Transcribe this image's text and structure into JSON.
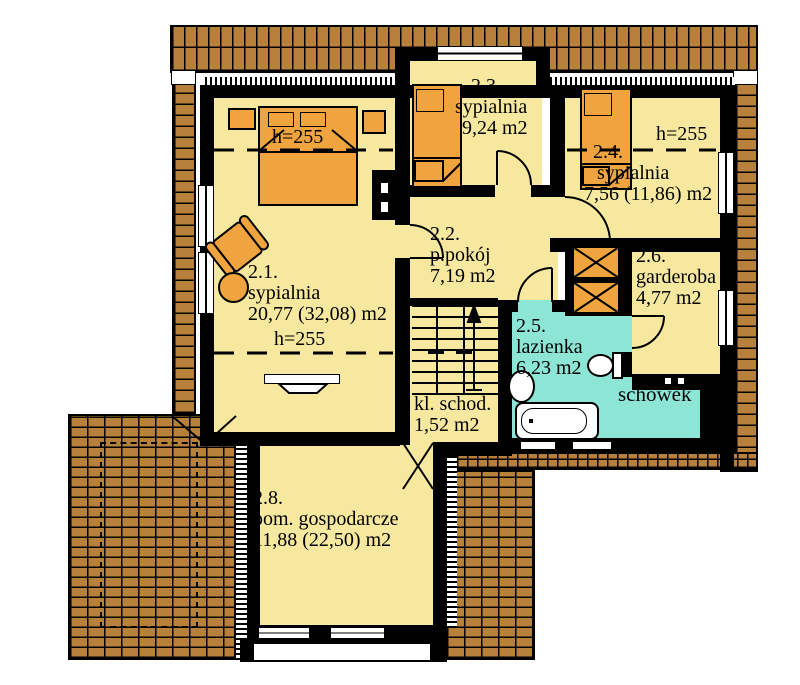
{
  "plan": {
    "title": "floor-plan-upper-storey",
    "rooms": [
      {
        "id": "2.1.",
        "name": "sypialnia",
        "area": "20,77 (32,08) m2"
      },
      {
        "id": "2.2.",
        "name": "p.pokój",
        "area": "7,19 m2"
      },
      {
        "id": "2.3.",
        "name": "sypialnia",
        "area": "9,24 m2"
      },
      {
        "id": "2.4.",
        "name": "sypialnia",
        "area": "7,56 (11,86) m2"
      },
      {
        "id": "2.5.",
        "name": "lazienka",
        "area": "6,23 m2"
      },
      {
        "id": "2.6.",
        "name": "garderoba",
        "area": "4,77 m2"
      },
      {
        "id": "2.8.",
        "name": "pom. gospodarcze",
        "area": "11,88 (22,50) m2"
      }
    ],
    "spaces": {
      "schowek": "schowek",
      "stairs_name": "kl. schod.",
      "stairs_area": "1,52 m2"
    },
    "height_label": "h=255",
    "colors": {
      "floor": "#f6e89e",
      "wet": "#8ce5d5",
      "furniture": "#f0a440",
      "roof": "#b8813b",
      "wall": "#000000",
      "background": "#ffffff"
    }
  }
}
